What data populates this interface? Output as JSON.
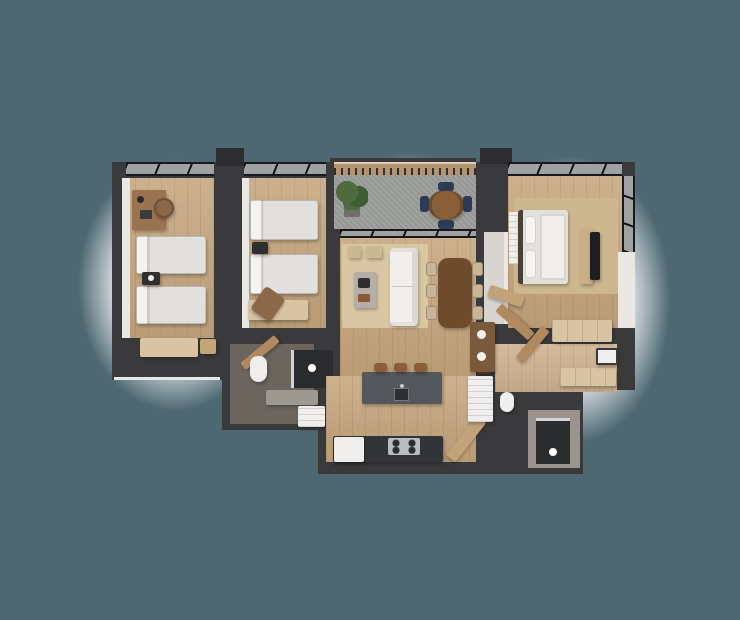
{
  "scene": {
    "type": "3d-floor-plan-render",
    "description": "Isometric top-down 3D render of an apartment floor plan with three bedrooms, balcony, living-dining room, kitchen and two bathrooms. No text labels are visible.",
    "background_color": "#4d6873",
    "glow_color": "#ffffff"
  },
  "colors": {
    "bg": "#4d6873",
    "wall": "#3a3a3c",
    "wallDark": "#2d2d30",
    "frame": "#18181a",
    "woodFloor": "#c7a77f",
    "woodFloorLight": "#d0b391",
    "concrete": "#9d9f9c",
    "rug": "#d9c7a4",
    "rugMaster": "#cdb78f",
    "bedding": "#e2e0dc",
    "pillow": "#f4f3f1",
    "sofa": "#f1efec",
    "darkWood": "#6e4b2c",
    "woodFurn": "#9a7450",
    "lightWood": "#d8c3a2",
    "chairBeige": "#c9b595",
    "navy": "#2c3a54",
    "plantGreen": "#4d6b3f",
    "plantGreenDark": "#3f5c34",
    "plantPot": "#6f6f68",
    "island": "#54585c",
    "counter": "#323437",
    "steel": "#b9bdbe",
    "appliance": "#e9e8e6",
    "fixture": "#efeeec",
    "showerTile": "#2b2c2e",
    "bathFloor": "#6b655e",
    "foyerFloor": "#d8d5d0",
    "vanityWood": "#7a5a3c",
    "railWood": "#b29470",
    "whiteWall": "#eae8e4"
  },
  "rooms": [
    {
      "id": "bedroom-1",
      "furniture": [
        "desk",
        "desk-chair",
        "twin-bed",
        "twin-bed",
        "nightstand",
        "bench"
      ]
    },
    {
      "id": "bedroom-2",
      "furniture": [
        "twin-bed",
        "twin-bed",
        "nightstand",
        "bench",
        "accent-chair"
      ]
    },
    {
      "id": "balcony",
      "furniture": [
        "potted-plant",
        "round-table",
        "navy-chair",
        "navy-chair",
        "navy-chair",
        "navy-chair"
      ]
    },
    {
      "id": "living-dining",
      "furniture": [
        "area-rug",
        "sofa",
        "coffee-table",
        "ottoman",
        "ottoman",
        "dining-table",
        "dining-chair-x6",
        "console"
      ]
    },
    {
      "id": "kitchen",
      "furniture": [
        "island-with-sink",
        "bar-stool-x3",
        "counter-with-cooktop",
        "refrigerator",
        "door"
      ]
    },
    {
      "id": "bathroom-2",
      "furniture": [
        "toilet",
        "shower",
        "vanity",
        "washer",
        "door"
      ]
    },
    {
      "id": "foyer",
      "furniture": []
    },
    {
      "id": "master-bedroom",
      "furniture": [
        "double-bed",
        "rug",
        "tv-console",
        "tv",
        "bench",
        "wardrobe",
        "louver-closet",
        "door"
      ]
    },
    {
      "id": "master-bathroom-closet",
      "furniture": [
        "wood-vanity",
        "white-cabinet",
        "toilet",
        "wardrobe",
        "wardrobe",
        "storage-box",
        "shower"
      ]
    }
  ]
}
